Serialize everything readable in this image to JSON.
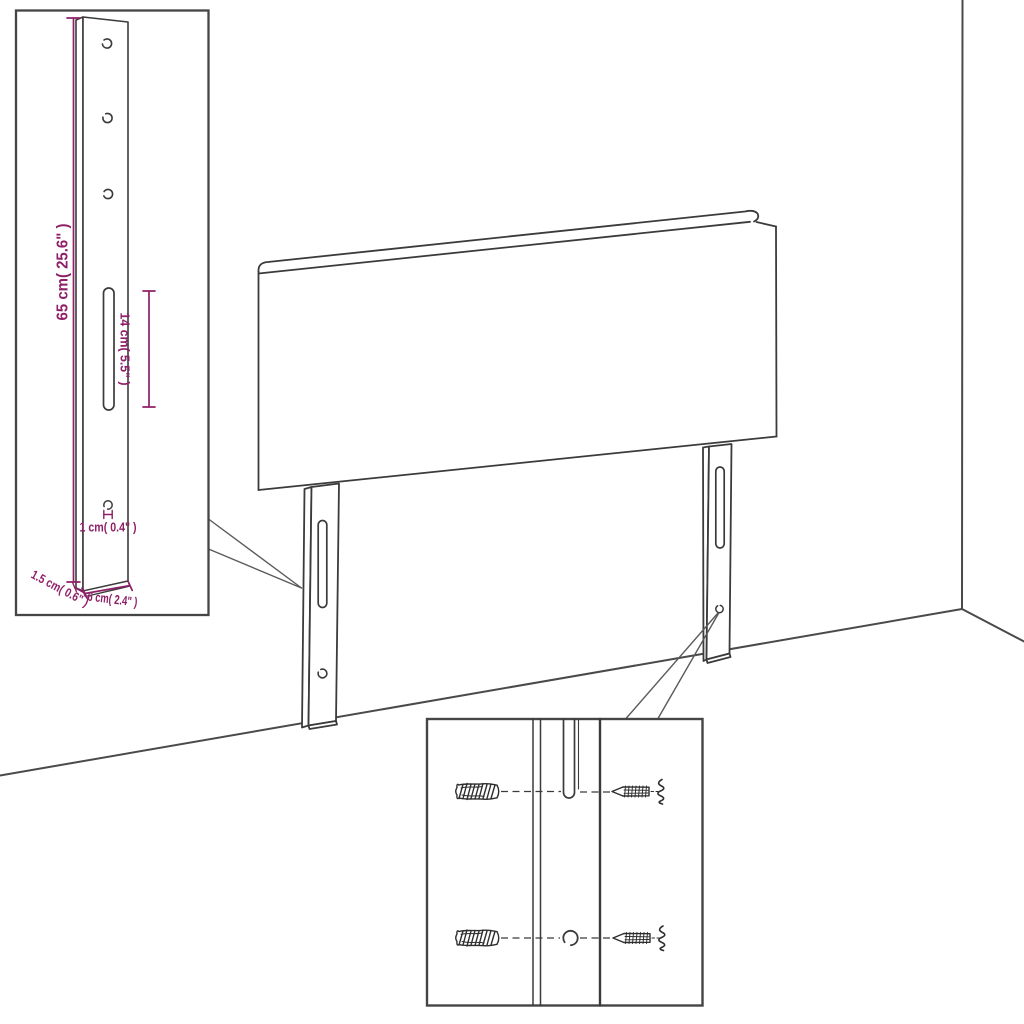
{
  "scene": {
    "background_color": "#ffffff",
    "line_color": "#3b3b3b",
    "dimension_color": "#8e1f68",
    "subject": "headboard with two slotted mounting legs shown against a room corner"
  },
  "dimension_inset": {
    "dimensions": [
      {
        "name": "leg-height",
        "label": "65 cm( 25.6\" )"
      },
      {
        "name": "slot-length",
        "label": "14 cm( 5.5\" )"
      },
      {
        "name": "hole-diameter",
        "label": "1 cm( 0.4\" )"
      },
      {
        "name": "leg-thickness",
        "label": "1.5 cm( 0.6\" )"
      },
      {
        "name": "leg-width",
        "label": "6 cm( 2.4\" )"
      }
    ]
  },
  "hardware_inset": {
    "icons": [
      {
        "name": "wall-plug-icon",
        "shape": "hatched-anchor-sketch"
      },
      {
        "name": "screw-icon",
        "shape": "left-pointing-screw-sketch"
      }
    ],
    "rows": 2
  }
}
